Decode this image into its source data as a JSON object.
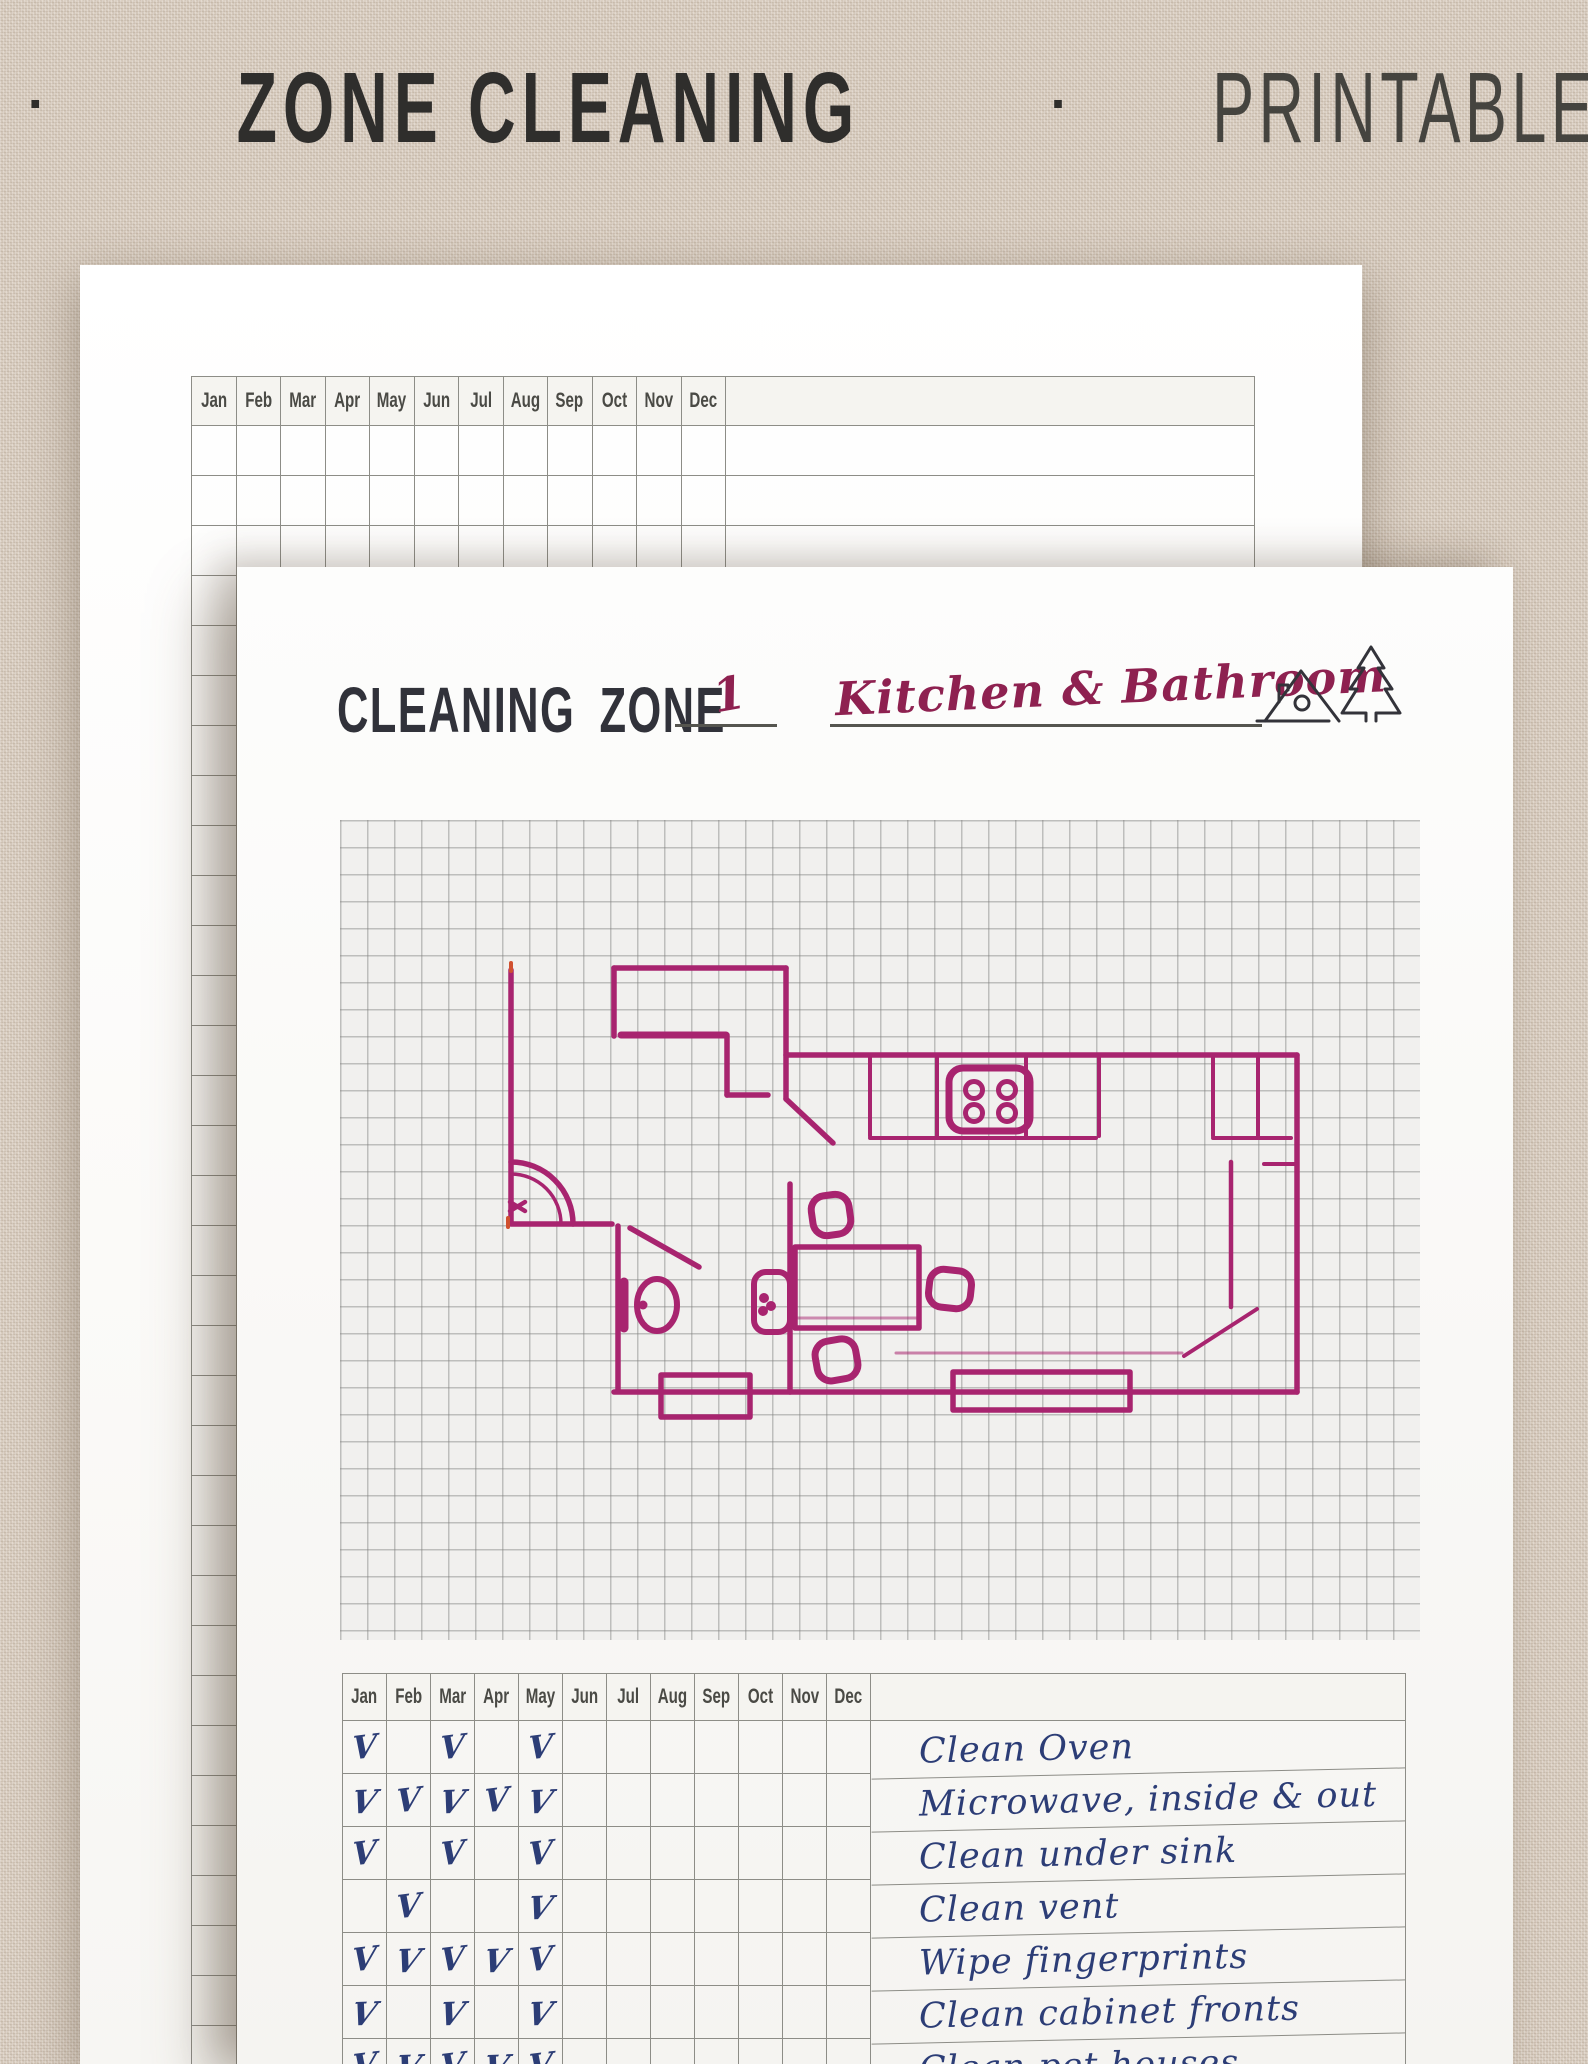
{
  "title": {
    "size_label": "A5",
    "separator": "·",
    "main_label": "ZONE CLEANING",
    "type_label": "PRINTABLE"
  },
  "months": [
    "Jan",
    "Feb",
    "Mar",
    "Apr",
    "May",
    "Jun",
    "Jul",
    "Aug",
    "Sep",
    "Oct",
    "Nov",
    "Dec"
  ],
  "front_page": {
    "header_label": "CLEANING ZONE",
    "zone_number": "1",
    "zone_name": "Kitchen & Bathroom",
    "icon": "house-and-pine-tree-icon",
    "check_symbol": "V",
    "checklist_rows": [
      {
        "task": "Clean Oven",
        "checked": [
          "Jan",
          "Mar",
          "May"
        ]
      },
      {
        "task": "Microwave, inside & out",
        "checked": [
          "Jan",
          "Feb",
          "Mar",
          "Apr",
          "May"
        ]
      },
      {
        "task": "Clean under sink",
        "checked": [
          "Jan",
          "Mar",
          "May"
        ]
      },
      {
        "task": "Clean vent",
        "checked": [
          "Feb",
          "May"
        ]
      },
      {
        "task": "Wipe fingerprints",
        "checked": [
          "Jan",
          "Feb",
          "Mar",
          "Apr",
          "May"
        ]
      },
      {
        "task": "Clean cabinet fronts",
        "checked": [
          "Jan",
          "Mar",
          "May"
        ]
      },
      {
        "task": "Clean pet houses",
        "checked": [
          "Jan",
          "Feb",
          "Mar",
          "Apr",
          "May"
        ]
      }
    ]
  },
  "back_page": {
    "empty_rows": 33
  },
  "floor_plan": {
    "ink_color": "#a8246f",
    "elements": [
      "walls",
      "entry-door-arc",
      "closet",
      "stove-cooktop",
      "kitchen-counter",
      "toilet",
      "bathroom-sink",
      "dining-table",
      "chairs",
      "windows"
    ]
  },
  "colors": {
    "background": "#d9cdc0",
    "title_text": "#2f2e2c",
    "plan_ink": "#a8246f",
    "zone_script": "#8e2150",
    "handwriting_blue": "#2c3d76",
    "table_border": "#8d8d87",
    "month_text": "#4a4a45"
  }
}
